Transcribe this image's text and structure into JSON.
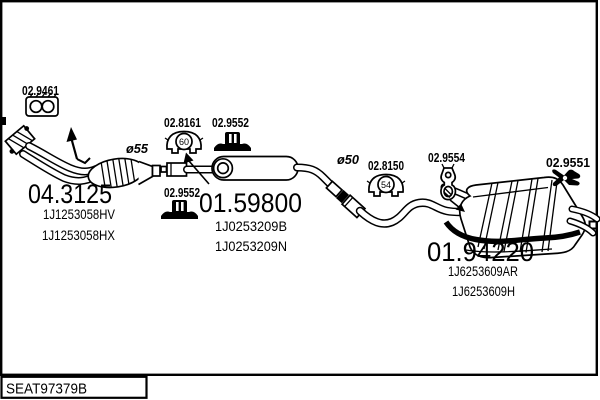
{
  "footer": {
    "code": "SEAT97379B"
  },
  "dimensions": {
    "front_pipe_diameter": "ø55",
    "mid_pipe_diameter": "ø50"
  },
  "parts": {
    "gasket": {
      "code": "02.9461"
    },
    "mount_60": {
      "code": "02.8161",
      "size_label": "60"
    },
    "clamp_top": {
      "code": "02.9552"
    },
    "clamp_bottom": {
      "code": "02.9552"
    },
    "mount_54": {
      "code": "02.8150",
      "size_label": "54"
    },
    "hanger_rear": {
      "code": "02.9554"
    },
    "mount_rear": {
      "code": "02.9551"
    },
    "front_pipe": {
      "code": "04.3125",
      "oem": [
        "1J1253058HV",
        "1J1253058HX"
      ]
    },
    "mid_muffler": {
      "code": "01.59800",
      "oem": [
        "1J0253209B",
        "1J0253209N"
      ]
    },
    "rear_muffler": {
      "code": "01.94220",
      "oem": [
        "1J6253609AR",
        "1J6253609H"
      ]
    }
  }
}
